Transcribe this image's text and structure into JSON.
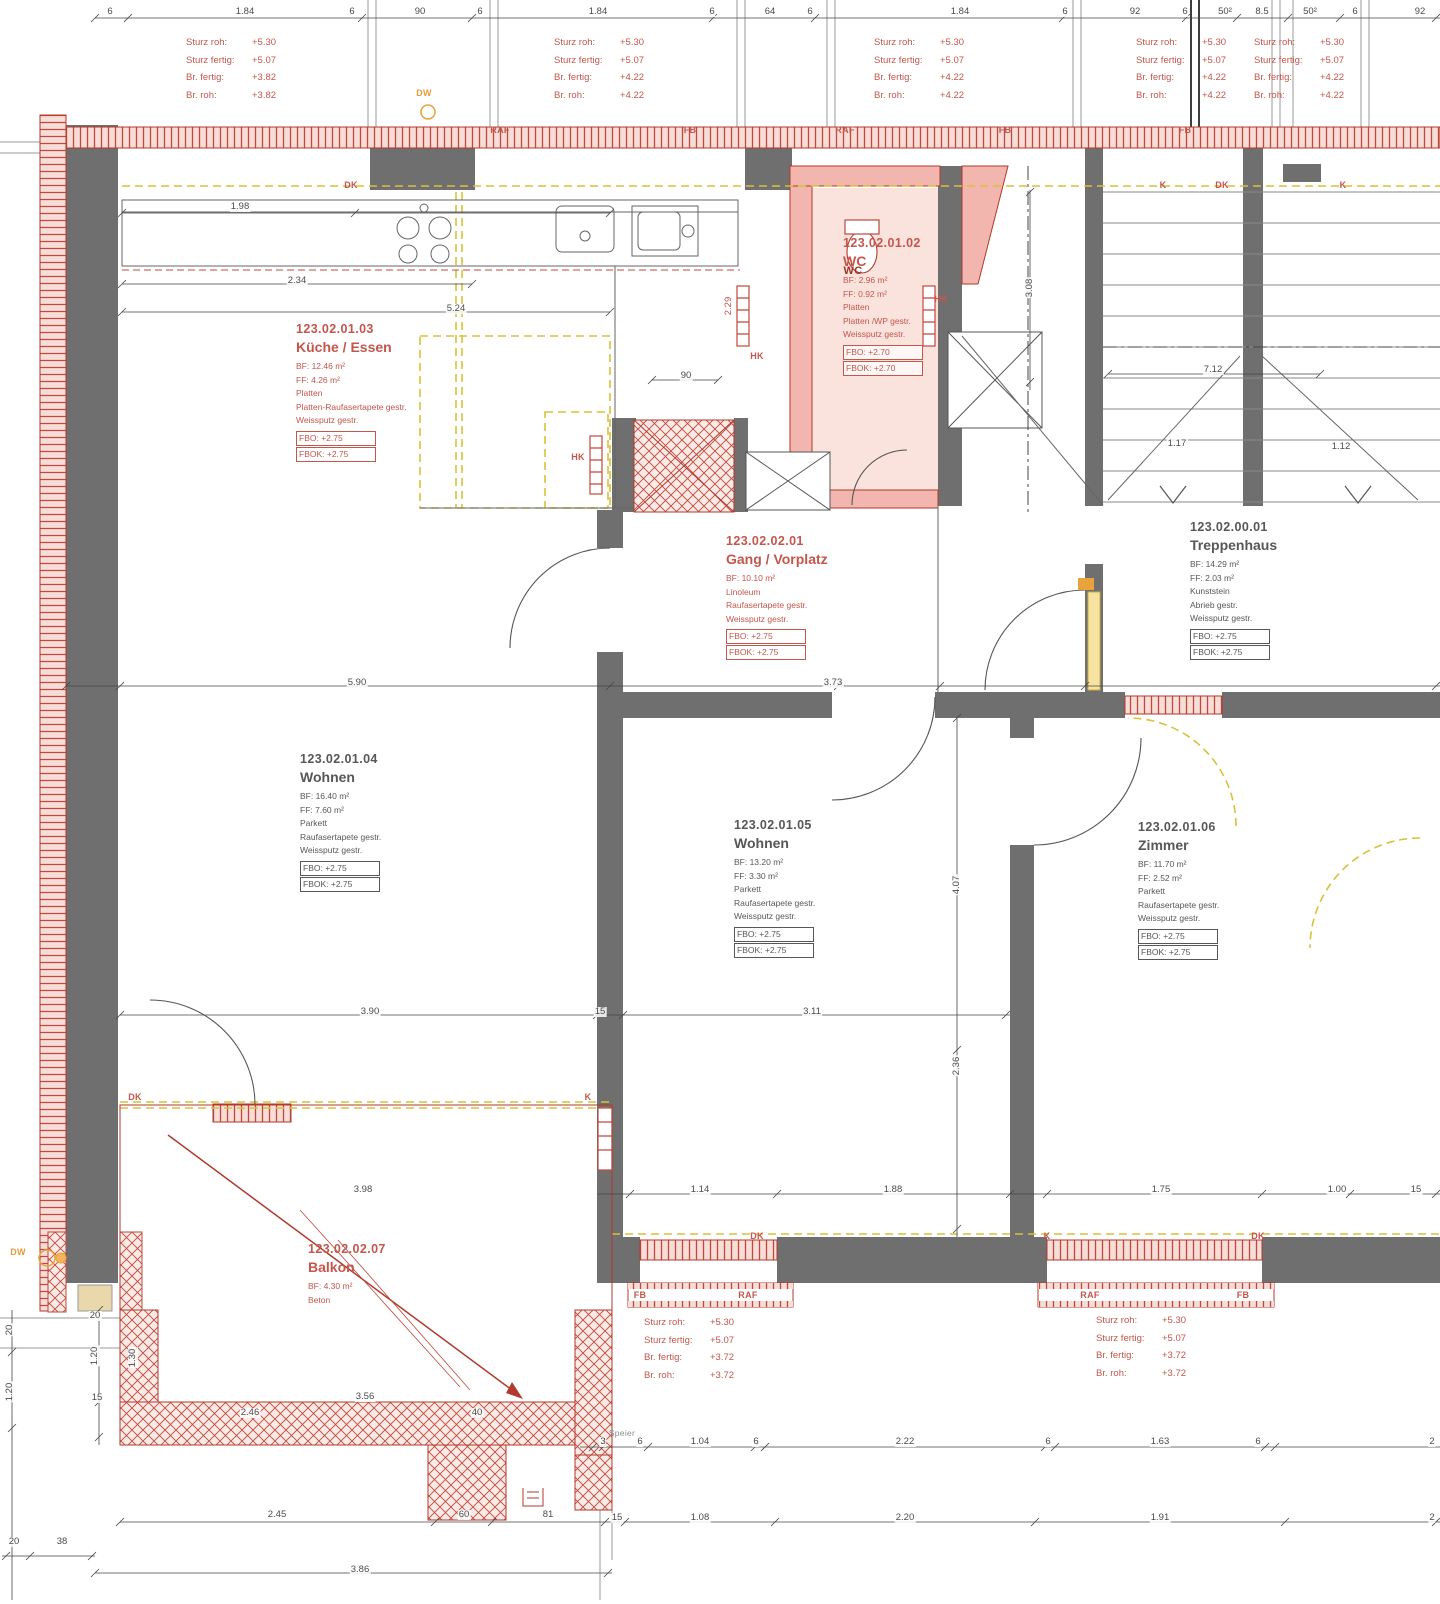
{
  "palette": {
    "wall_gray": "#6f6f6f",
    "red_line": "#b03a2e",
    "soft_red": "#c4564c",
    "pink_fill": "#f2b6ae",
    "pink_light": "#fbe3dd",
    "yellow_dash": "#d8c23a",
    "orange": "#e8a33d",
    "dim_text": "#4a4a4a"
  },
  "rooms": [
    {
      "id": "123.02.01.03",
      "name": "Küche / Essen",
      "tone": "red",
      "x": 296,
      "y": 322,
      "lines": [
        "BF: 12.46 m²",
        "FF: 4.26 m²",
        "Platten",
        "Platten-Raufasertapete gestr.",
        "Weissputz gestr."
      ],
      "fbo": "FBO: +2.75",
      "fbok": "FBOK: +2.75"
    },
    {
      "id": "123.02.01.02",
      "name": "WC",
      "tone": "red",
      "x": 843,
      "y": 236,
      "lines": [
        "BF: 2.96 m²",
        "FF: 0.92 m²",
        "Platten",
        "Platten /WP gestr.",
        "Weissputz gestr."
      ],
      "fbo": "FBO: +2.70",
      "fbok": "FBOK: +2.70"
    },
    {
      "id": "123.02.02.01",
      "name": "Gang / Vorplatz",
      "tone": "red",
      "x": 726,
      "y": 534,
      "lines": [
        "BF: 10.10 m²",
        "Linoleum",
        "Raufasertapete gestr.",
        "Weissputz gestr."
      ],
      "fbo": "FBO: +2.75",
      "fbok": "FBOK: +2.75"
    },
    {
      "id": "123.02.00.01",
      "name": "Treppenhaus",
      "tone": "dark",
      "x": 1190,
      "y": 520,
      "lines": [
        "BF: 14.29 m²",
        "FF: 2.03 m²",
        "Kunststein",
        "Abrieb gestr.",
        "Weissputz gestr."
      ],
      "fbo": "FBO: +2.75",
      "fbok": "FBOK: +2.75"
    },
    {
      "id": "123.02.01.04",
      "name": "Wohnen",
      "tone": "dark",
      "x": 300,
      "y": 752,
      "lines": [
        "BF: 16.40 m²",
        "FF: 7.60 m²",
        "Parkett",
        "Raufasertapete gestr.",
        "Weissputz gestr."
      ],
      "fbo": "FBO: +2.75",
      "fbok": "FBOK: +2.75"
    },
    {
      "id": "123.02.01.05",
      "name": "Wohnen",
      "tone": "dark",
      "x": 734,
      "y": 818,
      "lines": [
        "BF: 13.20 m²",
        "FF: 3.30 m²",
        "Parkett",
        "Raufasertapete gestr.",
        "Weissputz gestr."
      ],
      "fbo": "FBO: +2.75",
      "fbok": "FBOK: +2.75"
    },
    {
      "id": "123.02.01.06",
      "name": "Zimmer",
      "tone": "dark",
      "x": 1138,
      "y": 820,
      "lines": [
        "BF: 11.70 m²",
        "FF: 2.52 m²",
        "Parkett",
        "Raufasertapete gestr.",
        "Weissputz gestr."
      ],
      "fbo": "FBO: +2.75",
      "fbok": "FBOK: +2.75"
    },
    {
      "id": "123.02.02.07",
      "name": "Balkon",
      "tone": "red",
      "x": 308,
      "y": 1242,
      "lines": [
        "BF: 4.30 m²",
        "Beton"
      ]
    }
  ],
  "notes": [
    {
      "x": 186,
      "y": 34,
      "rows": [
        [
          "Sturz roh:",
          "+5.30"
        ],
        [
          "Sturz fertig:",
          "+5.07"
        ],
        [
          "Br. fertig:",
          "+3.82"
        ],
        [
          "Br. roh:",
          "+3.82"
        ]
      ]
    },
    {
      "x": 554,
      "y": 34,
      "rows": [
        [
          "Sturz roh:",
          "+5.30"
        ],
        [
          "Sturz fertig:",
          "+5.07"
        ],
        [
          "Br. fertig:",
          "+4.22"
        ],
        [
          "Br. roh:",
          "+4.22"
        ]
      ]
    },
    {
      "x": 874,
      "y": 34,
      "rows": [
        [
          "Sturz roh:",
          "+5.30"
        ],
        [
          "Sturz fertig:",
          "+5.07"
        ],
        [
          "Br. fertig:",
          "+4.22"
        ],
        [
          "Br. roh:",
          "+4.22"
        ]
      ]
    },
    {
      "x": 1136,
      "y": 34,
      "rows": [
        [
          "Sturz roh:",
          "+5.30"
        ],
        [
          "Sturz fertig:",
          "+5.07"
        ],
        [
          "Br. fertig:",
          "+4.22"
        ],
        [
          "Br. roh:",
          "+4.22"
        ]
      ]
    },
    {
      "x": 1254,
      "y": 34,
      "rows": [
        [
          "Sturz roh:",
          "+5.30"
        ],
        [
          "Sturz fertig:",
          "+5.07"
        ],
        [
          "Br. fertig:",
          "+4.22"
        ],
        [
          "Br. roh:",
          "+4.22"
        ]
      ]
    },
    {
      "x": 644,
      "y": 1314,
      "rows": [
        [
          "Sturz roh:",
          "+5.30"
        ],
        [
          "Sturz fertig:",
          "+5.07"
        ],
        [
          "Br. fertig:",
          "+3.72"
        ],
        [
          "Br. roh:",
          "+3.72"
        ]
      ]
    },
    {
      "x": 1096,
      "y": 1312,
      "rows": [
        [
          "Sturz roh:",
          "+5.30"
        ],
        [
          "Sturz fertig:",
          "+5.07"
        ],
        [
          "Br. fertig:",
          "+3.72"
        ],
        [
          "Br. roh:",
          "+3.72"
        ]
      ]
    }
  ],
  "band_labels": [
    {
      "t": "RAF",
      "x": 500,
      "y": 130
    },
    {
      "t": "FB",
      "x": 690,
      "y": 130
    },
    {
      "t": "RAF",
      "x": 845,
      "y": 130
    },
    {
      "t": "FB",
      "x": 1005,
      "y": 130
    },
    {
      "t": "FB",
      "x": 1185,
      "y": 130
    },
    {
      "t": "DK",
      "x": 351,
      "y": 185
    },
    {
      "t": "K",
      "x": 1163,
      "y": 185
    },
    {
      "t": "DK",
      "x": 1222,
      "y": 185
    },
    {
      "t": "K",
      "x": 1343,
      "y": 185
    },
    {
      "t": "DK",
      "x": 135,
      "y": 1097
    },
    {
      "t": "K",
      "x": 588,
      "y": 1097
    },
    {
      "t": "DK",
      "x": 757,
      "y": 1236
    },
    {
      "t": "K",
      "x": 1047,
      "y": 1236
    },
    {
      "t": "DK",
      "x": 1258,
      "y": 1236
    },
    {
      "t": "FB",
      "x": 640,
      "y": 1295
    },
    {
      "t": "RAF",
      "x": 748,
      "y": 1295
    },
    {
      "t": "RAF",
      "x": 1090,
      "y": 1295
    },
    {
      "t": "FB",
      "x": 1243,
      "y": 1295
    },
    {
      "t": "HK",
      "x": 757,
      "y": 356
    },
    {
      "t": "HK",
      "x": 941,
      "y": 299
    },
    {
      "t": "HK",
      "x": 578,
      "y": 457
    },
    {
      "t": "DW",
      "x": 424,
      "y": 93,
      "c": "orange"
    },
    {
      "t": "DW",
      "x": 18,
      "y": 1252,
      "c": "orange"
    },
    {
      "t": "WC",
      "x": 853,
      "y": 271,
      "c": "darkred"
    },
    {
      "t": "Speier",
      "x": 622,
      "y": 1433,
      "c": "gray"
    }
  ],
  "dim_labels": [
    {
      "t": "6",
      "x": 110,
      "y": 12
    },
    {
      "t": "1.84",
      "x": 245,
      "y": 12
    },
    {
      "t": "6",
      "x": 352,
      "y": 12
    },
    {
      "t": "90",
      "x": 420,
      "y": 12
    },
    {
      "t": "6",
      "x": 480,
      "y": 12
    },
    {
      "t": "1.84",
      "x": 598,
      "y": 12
    },
    {
      "t": "6",
      "x": 712,
      "y": 12
    },
    {
      "t": "64",
      "x": 770,
      "y": 12
    },
    {
      "t": "6",
      "x": 810,
      "y": 12
    },
    {
      "t": "1.84",
      "x": 960,
      "y": 12
    },
    {
      "t": "6",
      "x": 1065,
      "y": 12
    },
    {
      "t": "92",
      "x": 1135,
      "y": 12
    },
    {
      "t": "6",
      "x": 1185,
      "y": 12
    },
    {
      "t": "50²",
      "x": 1225,
      "y": 12
    },
    {
      "t": "8.5",
      "x": 1262,
      "y": 12
    },
    {
      "t": "50²",
      "x": 1310,
      "y": 12
    },
    {
      "t": "6",
      "x": 1355,
      "y": 12
    },
    {
      "t": "92",
      "x": 1420,
      "y": 12
    },
    {
      "t": "1.98",
      "x": 240,
      "y": 207
    },
    {
      "t": "2.34",
      "x": 297,
      "y": 281
    },
    {
      "t": "5.24",
      "x": 456,
      "y": 309
    },
    {
      "t": "90",
      "x": 686,
      "y": 376
    },
    {
      "t": "2.29",
      "x": 729,
      "y": 306,
      "r": 90,
      "c": "red"
    },
    {
      "t": "3.08",
      "x": 1030,
      "y": 288,
      "r": 90
    },
    {
      "t": "7.12",
      "x": 1213,
      "y": 370
    },
    {
      "t": "1.17",
      "x": 1177,
      "y": 444
    },
    {
      "t": "1.12",
      "x": 1341,
      "y": 447
    },
    {
      "t": "5.90",
      "x": 357,
      "y": 683
    },
    {
      "t": "3.73",
      "x": 833,
      "y": 683
    },
    {
      "t": "3.90",
      "x": 370,
      "y": 1012
    },
    {
      "t": "15",
      "x": 600,
      "y": 1012
    },
    {
      "t": "3.11",
      "x": 812,
      "y": 1012
    },
    {
      "t": "4.07",
      "x": 957,
      "y": 885,
      "r": 90
    },
    {
      "t": "2.36",
      "x": 957,
      "y": 1066,
      "r": 90
    },
    {
      "t": "3.98",
      "x": 363,
      "y": 1190
    },
    {
      "t": "1.14",
      "x": 700,
      "y": 1190
    },
    {
      "t": "1.88",
      "x": 893,
      "y": 1190
    },
    {
      "t": "1.75",
      "x": 1161,
      "y": 1190
    },
    {
      "t": "1.00",
      "x": 1337,
      "y": 1190
    },
    {
      "t": "15",
      "x": 1416,
      "y": 1190
    },
    {
      "t": "20",
      "x": 95,
      "y": 1316
    },
    {
      "t": "1.20",
      "x": 95,
      "y": 1356,
      "r": 90
    },
    {
      "t": "1.30",
      "x": 133,
      "y": 1358,
      "r": 90
    },
    {
      "t": "15",
      "x": 97,
      "y": 1398
    },
    {
      "t": "3.56",
      "x": 365,
      "y": 1397
    },
    {
      "t": "2.46",
      "x": 250,
      "y": 1413
    },
    {
      "t": "40",
      "x": 477,
      "y": 1413
    },
    {
      "t": "3",
      "x": 603,
      "y": 1442
    },
    {
      "t": "6",
      "x": 640,
      "y": 1442
    },
    {
      "t": "1.04",
      "x": 700,
      "y": 1442
    },
    {
      "t": "6",
      "x": 756,
      "y": 1442
    },
    {
      "t": "2.22",
      "x": 905,
      "y": 1442
    },
    {
      "t": "6",
      "x": 1048,
      "y": 1442
    },
    {
      "t": "1.63",
      "x": 1160,
      "y": 1442
    },
    {
      "t": "6",
      "x": 1258,
      "y": 1442
    },
    {
      "t": "2",
      "x": 1432,
      "y": 1442
    },
    {
      "t": "2.45",
      "x": 277,
      "y": 1515
    },
    {
      "t": "60",
      "x": 464,
      "y": 1515
    },
    {
      "t": "81",
      "x": 548,
      "y": 1515
    },
    {
      "t": "15",
      "x": 617,
      "y": 1518
    },
    {
      "t": "1.08",
      "x": 700,
      "y": 1518
    },
    {
      "t": "2.20",
      "x": 905,
      "y": 1518
    },
    {
      "t": "1.91",
      "x": 1160,
      "y": 1518
    },
    {
      "t": "2",
      "x": 1432,
      "y": 1518
    },
    {
      "t": "20",
      "x": 14,
      "y": 1542
    },
    {
      "t": "38",
      "x": 62,
      "y": 1542
    },
    {
      "t": "3.86",
      "x": 360,
      "y": 1570
    },
    {
      "t": "20",
      "x": 10,
      "y": 1330,
      "r": 90
    },
    {
      "t": "1.20",
      "x": 10,
      "y": 1392,
      "r": 90
    }
  ]
}
